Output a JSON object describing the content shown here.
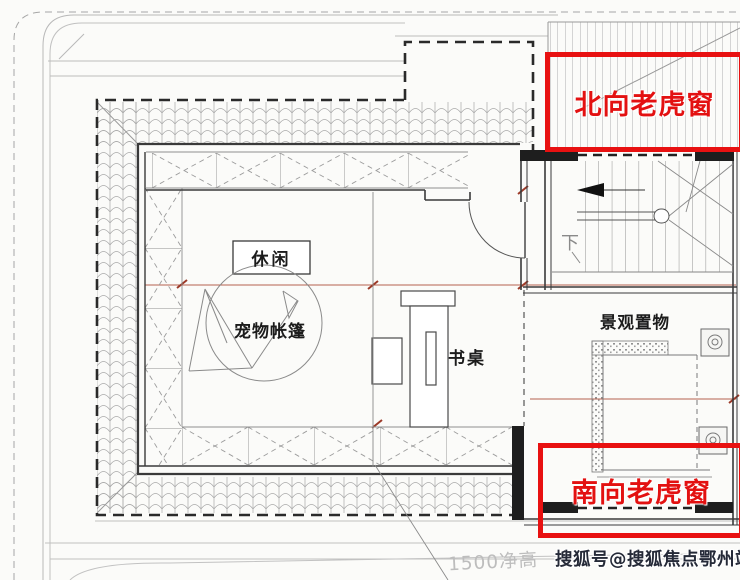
{
  "annotations": {
    "north_dormer": {
      "label": "北向老虎窗"
    },
    "south_dormer": {
      "label": "南向老虎窗"
    }
  },
  "plan": {
    "labels": {
      "leisure": "休闲",
      "pet_tent": "宠物帐篷",
      "desk": "书桌",
      "landscape_shelf": "景观置物",
      "stairs_down": "下"
    },
    "notes": {
      "ceiling_height": "1500净高"
    }
  },
  "watermark": {
    "text": "搜狐号@搜狐焦点鄂州站"
  },
  "colors": {
    "annotation_red": "#e81111",
    "line_gray": "#b8b8b8",
    "wall_dark": "#3a3a3a"
  }
}
